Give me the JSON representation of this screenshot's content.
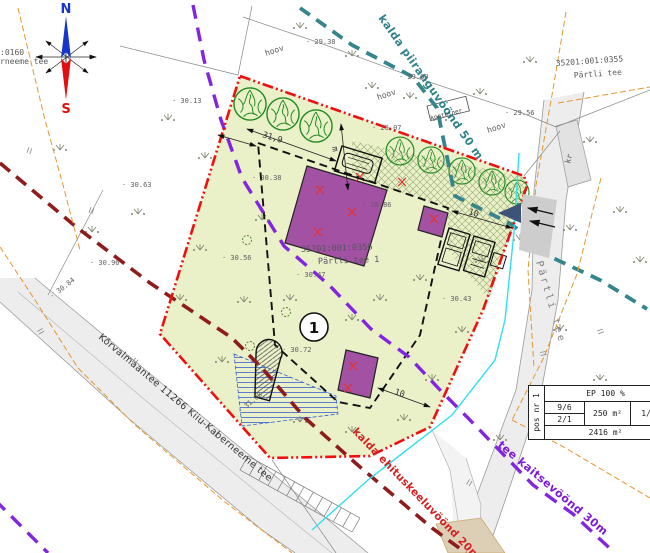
{
  "compass": {
    "north": "N",
    "south": "S"
  },
  "edge_labels": {
    "cadastre_fragment": ":0160",
    "road_fragment": "rneeme tee"
  },
  "zones": {
    "shore_limit": {
      "label": "kalda piiranguvöönd 50 m",
      "color": "#35858d"
    },
    "road_protection": {
      "label": "tee kaitsevöönd 30m",
      "color": "#8325e0"
    },
    "building_exclusion": {
      "label": "kalda ehituskeeluvöönd 20m",
      "color": "#d42020"
    }
  },
  "parcels": {
    "site": {
      "cadastre": "35201:001:0356",
      "name": "Pärtli tee 1"
    },
    "north": {
      "cadastre": "35201:001:0355",
      "name": "Pärtli tee"
    }
  },
  "roads": {
    "east": "Pärtli tee",
    "south": "Kõrvalmaantee 11266 Kiiu-Kaberneeme tee"
  },
  "marker": {
    "number": "1"
  },
  "dimensions": {
    "top_width": "31,9",
    "height_unit": "m",
    "east_setback": "10",
    "south_setback": "10"
  },
  "area_labels": {
    "yard_a": "hoov",
    "yard_b": "hoov",
    "yard_c": "hoov",
    "container": "konteiner",
    "gravel_road": "kr"
  },
  "elevations": [
    {
      "t": "30.13",
      "x": 172,
      "y": 103
    },
    {
      "t": "29.38",
      "x": 306,
      "y": 44
    },
    {
      "t": "29.60",
      "x": 399,
      "y": 79
    },
    {
      "t": "29.56",
      "x": 505,
      "y": 115
    },
    {
      "t": "29.07",
      "x": 372,
      "y": 130
    },
    {
      "t": "30.63",
      "x": 122,
      "y": 187
    },
    {
      "t": "30.96",
      "x": 90,
      "y": 265
    },
    {
      "t": "30.84",
      "x": 52,
      "y": 299,
      "r": -38
    },
    {
      "t": "30.38",
      "x": 252,
      "y": 180
    },
    {
      "t": "30.86",
      "x": 362,
      "y": 207
    },
    {
      "t": "30.56",
      "x": 222,
      "y": 260
    },
    {
      "t": "30.47",
      "x": 296,
      "y": 277
    },
    {
      "t": "30.72",
      "x": 282,
      "y": 352
    },
    {
      "t": "30.43",
      "x": 442,
      "y": 301
    },
    {
      "t": "31.08",
      "x": 240,
      "y": 414,
      "r": -40
    }
  ],
  "table": {
    "pos": "pos nr 1",
    "build_intensity": "EP 100 %",
    "floors_a": "9/6",
    "floors_b": "2/1",
    "building_area": "250 m²",
    "ratio": "1/2",
    "plot_area": "2416 m²"
  },
  "colors": {
    "site_fill": "#eaf0c8",
    "boundary": "#ef0f0f",
    "building": "#a351a3",
    "tree": "#1e8a1e",
    "road": "#eeeeee",
    "water_hatch": "#3a5fd0",
    "entrance_arrow": "#3d5377",
    "orange_utility": "#e6972f",
    "cyan_utility": "#2fe0ee",
    "maroon_zone": "#8e1c1c"
  }
}
